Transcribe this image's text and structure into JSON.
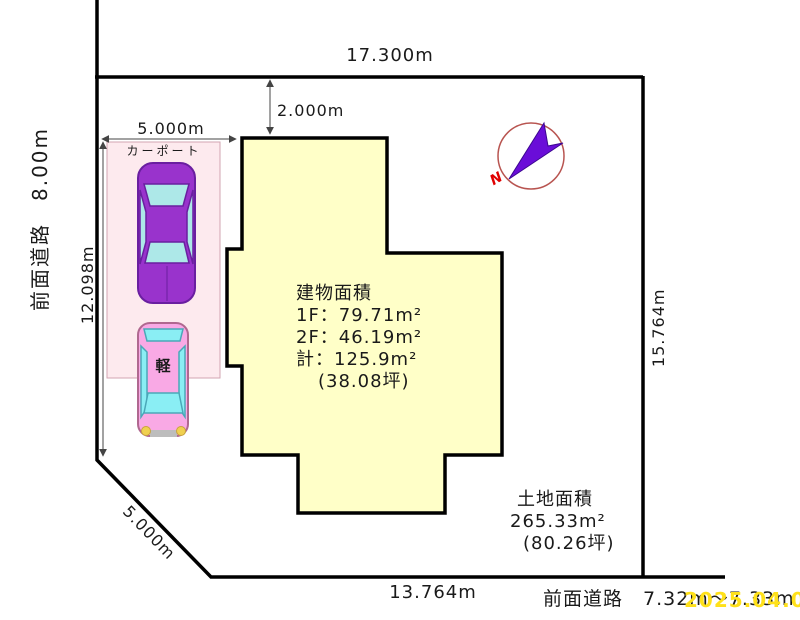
{
  "dims": {
    "top": "17.300m",
    "setback": "2.000m",
    "carport_width": "5.000m",
    "left": "12.098m",
    "right": "15.764m",
    "bottom": "13.764m",
    "corner": "5.000m"
  },
  "roads": {
    "left_label": "前面道路　8.00m",
    "bottom_label": "前面道路　7.32m～7.33m"
  },
  "carport": {
    "label": "カーポート",
    "kei_badge": "軽"
  },
  "building": {
    "title": "建物面積",
    "floor1": "1F：79.71m²",
    "floor2": "2F：46.19m²",
    "total": "計：125.9m²",
    "tsubo": "(38.08坪)"
  },
  "land": {
    "title": "土地面積",
    "area": "265.33m²",
    "tsubo": "(80.26坪)"
  },
  "compass": {
    "north": "N"
  },
  "watermark": "2025.04.04",
  "colors": {
    "building_fill": "#ffffc8",
    "carport_fill": "#fdeaee",
    "boundary": "#000000",
    "sedan_body": "#9933cc",
    "sedan_outline": "#6a1fa0",
    "kei_body": "#f9a9e5",
    "kei_outline": "#b06890",
    "window_cyan": "#ade8e8",
    "kei_window": "#8aeef4",
    "headlight_yellow": "#f0d050",
    "compass_ring": "#b85450",
    "compass_needle": "#6a0dd8",
    "north_red": "#e00000",
    "watermark_yellow": "#ffe11a"
  }
}
